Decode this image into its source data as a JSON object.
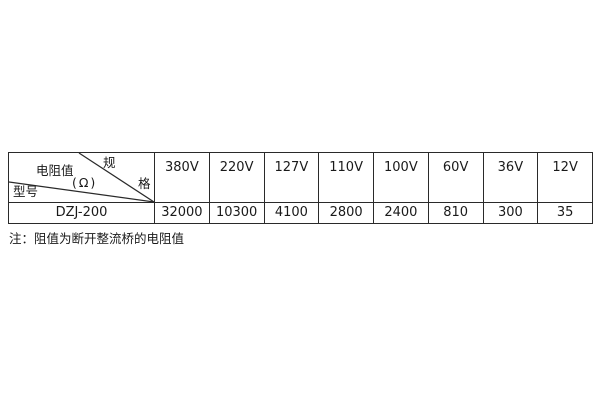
{
  "table": {
    "diagonal_header": {
      "spec_char_top": "规",
      "spec_char_bottom": "格",
      "resistance_label": "电阻值",
      "resistance_unit": "(Ω)",
      "model_label": "型号"
    },
    "model": "DZJ-200",
    "columns": [
      {
        "voltage": "380V",
        "resistance": "32000"
      },
      {
        "voltage": "220V",
        "resistance": "10300"
      },
      {
        "voltage": "127V",
        "resistance": "4100"
      },
      {
        "voltage": "110V",
        "resistance": "2800"
      },
      {
        "voltage": "100V",
        "resistance": "2400"
      },
      {
        "voltage": "60V",
        "resistance": "810"
      },
      {
        "voltage": "36V",
        "resistance": "300"
      },
      {
        "voltage": "12V",
        "resistance": "35"
      }
    ]
  },
  "note": "注：阻值为断开整流桥的电阻值",
  "colors": {
    "border": "#2a2a2a",
    "text": "#1a1a1a",
    "background": "#ffffff"
  }
}
